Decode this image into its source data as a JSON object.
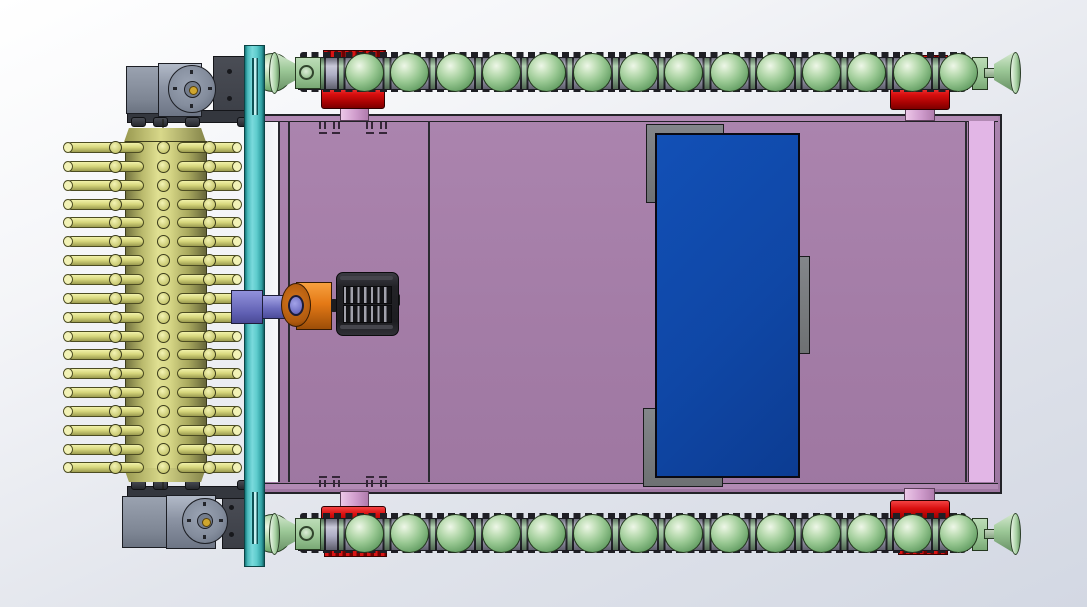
{
  "viewport": {
    "width": 1087,
    "height": 607,
    "description": "3D CAD top view of tracked cleaning robot assembly",
    "visible_text": ""
  },
  "palette": {
    "background_top": "#ffffff",
    "background_bottom": "#d3d8e3",
    "chassis_mauve": "#a47da7",
    "chassis_light_strip": "#e2b6e6",
    "outline_dark": "#26262b",
    "side_plate_teal": "#5ecccd",
    "track_ball_green": "#97c791",
    "link_plate_lavender": "#b8b8ce",
    "link_green": "#8fbf8f",
    "sprocket_red": "#d80e0e",
    "axle_pink": "#cf9ccc",
    "brush_yellow": "#d6d67c",
    "drive_shaft_purple": "#6a6abc",
    "coupling_orange": "#e47916",
    "brush_motor_black": "#232327",
    "panel_blue": "#0f47a6",
    "bracket_gray": "#75787a",
    "motor_gray": "#8b93a3",
    "hub_gold": "#cfa62e"
  },
  "tracks": {
    "ball_count_per_track": 14,
    "first_ball_cx": 364,
    "ball_spacing": 45.7,
    "ball_diameter": 39,
    "top_track_cy": 72,
    "bottom_track_cy": 533,
    "band_left": 298,
    "band_width": 670
  },
  "brush": {
    "pin_rows": 18,
    "first_row_cy": 147.5,
    "row_spacing": 18.85,
    "row_left": 64
  },
  "brush_motor": {
    "fin_rows": 2,
    "fins_per_row": 11
  },
  "vents": {
    "group_x": [
      319,
      366
    ],
    "tick_offsets": [
      0,
      5,
      14,
      19
    ],
    "dash_offsets": [
      0,
      13
    ],
    "top_tick_y": 121.5,
    "top_dash_y": 131.5,
    "bottom_tick_y": 479.5,
    "bottom_dash_y": 475.5
  }
}
